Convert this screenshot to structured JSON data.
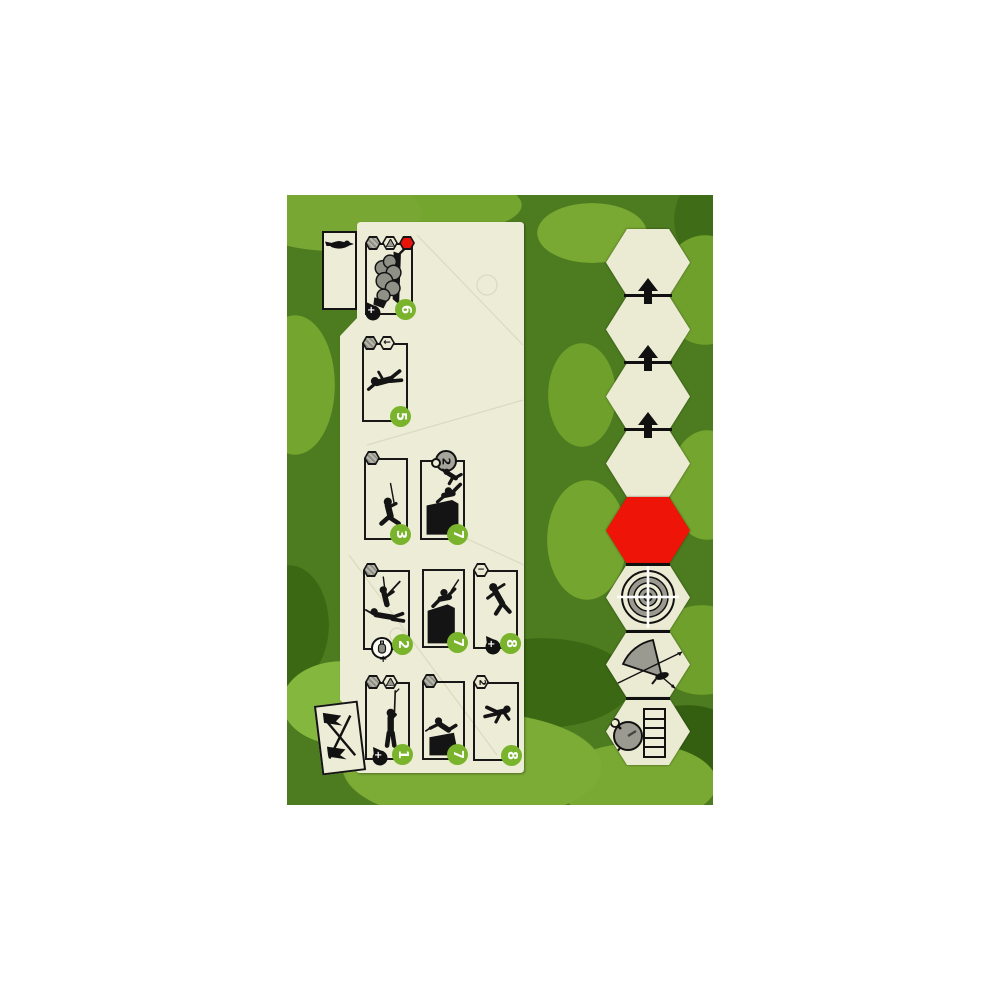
{
  "game": {
    "component": "solitaire-wargame-player-mat-and-hex-track"
  },
  "colors": {
    "camo_base": "#4c7c1f",
    "camo_light": "#78a733",
    "camo_bright": "#84b73e",
    "camo_dark": "#3a6813",
    "board_cream": "#edecd7",
    "hex_cream": "#ebead3",
    "ink": "#141414",
    "value_green": "#79b42c",
    "alert_red": "#ee1408",
    "icon_gray": "#9a9a90"
  },
  "tabs": {
    "bird_icon": "crow-silhouette",
    "flags_icon": "crossed-flags"
  },
  "markers": {
    "plus_glyph": "+"
  },
  "cards": [
    {
      "value": "6",
      "icons": [
        "gray-hex",
        "mountain-hex",
        "red-hex"
      ],
      "art": "soldier-in-smoke",
      "corner": "plus-marker"
    },
    {
      "value": "5",
      "icons": [
        "gray-hex",
        "arrow-left-hex"
      ],
      "arrow_glyph": "←",
      "art": "crawling-soldier"
    },
    {
      "value": "3",
      "icons": [
        "gray-hex"
      ],
      "art": "kneeling-rifleman"
    },
    {
      "value": "7",
      "icons": [
        "timer-badge"
      ],
      "timer": "2",
      "art": "soldiers-climbing-wall"
    },
    {
      "value": "2",
      "icons": [
        "gray-hex"
      ],
      "art": "two-soldiers-firing",
      "corner": "grenade-plus"
    },
    {
      "value": "7",
      "icons": [],
      "art": "soldier-over-wall"
    },
    {
      "value": "8",
      "icons": [
        "minus-hex"
      ],
      "minus_glyph": "−",
      "art": "falling-soldier",
      "corner": "plus-marker"
    },
    {
      "value": "1",
      "icons": [
        "gray-hex",
        "mountain-hex"
      ],
      "art": "standing-rifleman",
      "corner": "plus-marker"
    },
    {
      "value": "7",
      "icons": [
        "gray-hex"
      ],
      "art": "soldier-over-low-wall"
    },
    {
      "value": "8",
      "icons": [
        "number-hex"
      ],
      "hex_number": "2",
      "art": "leaping-soldier"
    }
  ],
  "hex_track": {
    "hexes": [
      "blank",
      "blank-with-advance-arrow",
      "blank-with-advance-arrow",
      "blank-with-advance-arrow",
      "red-alert",
      "target-crosshair",
      "fire-arc-gun",
      "stopwatch-with-track"
    ],
    "track_cells": 5
  }
}
